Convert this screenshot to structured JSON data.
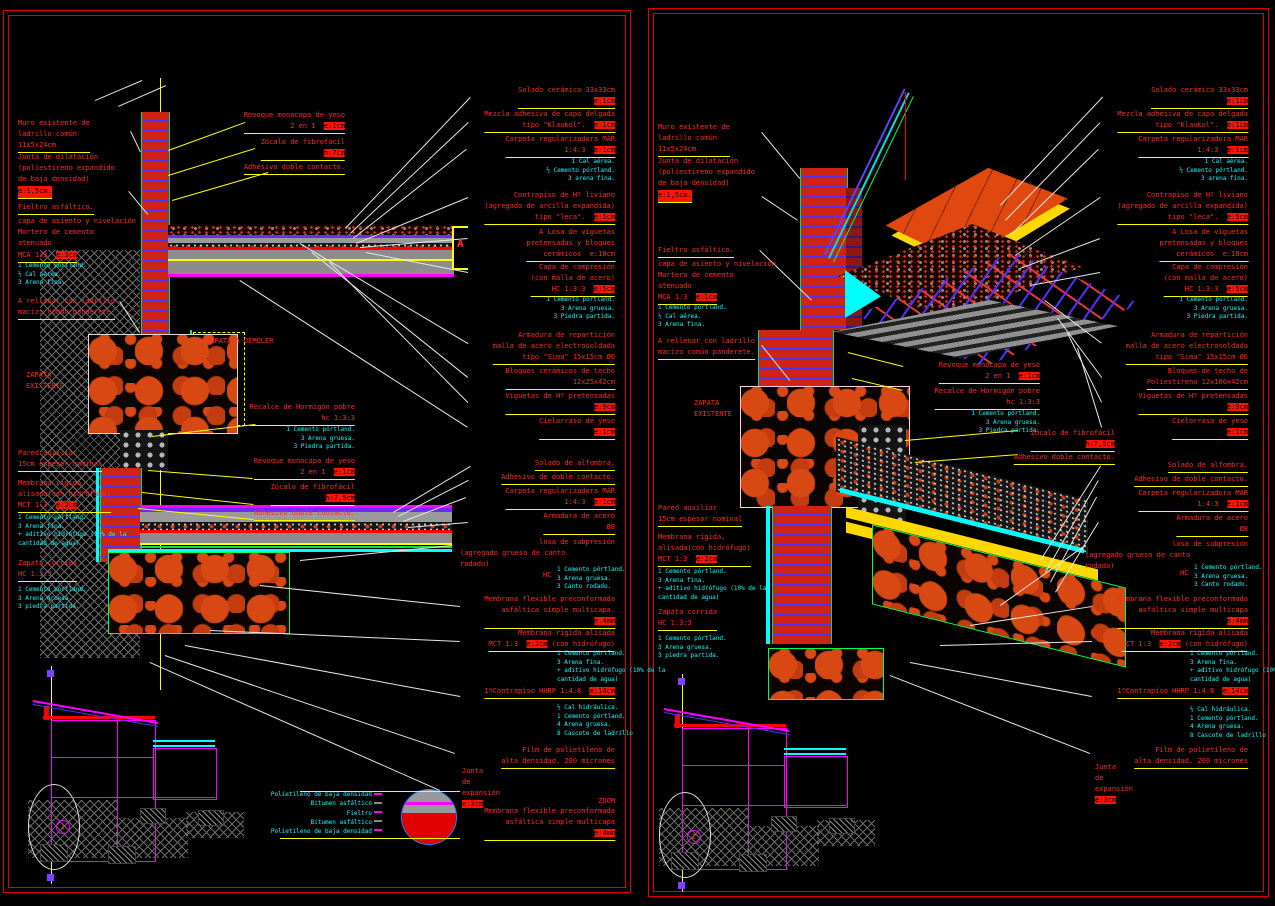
{
  "sheet": {
    "type": "CAD construction detail drawing",
    "background": "#000000",
    "colors": {
      "annotation_red": "#ff2a1e",
      "highlight_value": "#ff1400",
      "mix_notes_cyan": "#00ffff",
      "leader_yellow": "#ffff00",
      "leader_white": "#e8e8e8",
      "sketch_magenta": "#ff00ff",
      "brick_red": "#cf2414",
      "outline_green": "#00ff50",
      "panel_border_red": "#e00000"
    }
  },
  "panels": [
    {
      "name": "detalle-seccion-1",
      "marker": {
        "label": "1",
        "x": 56,
        "y": 820
      },
      "labels": [
        {
          "t": "Muro existente de\nladrillo común\n11x5x24cm",
          "x": 18,
          "y": 118,
          "ul": 1
        },
        {
          "t": "Junta de dilatación\n(poliestireno expandido\nde baja densidad)",
          "x": 18,
          "y": 152
        },
        {
          "t": "e:1,5cm.",
          "x": 18,
          "y": 186,
          "bg": 1,
          "ul": 1
        },
        {
          "t": "Fieltro asfáltico.",
          "x": 18,
          "y": 202,
          "ul": 1
        },
        {
          "t": "capa de asiento y nivelación\nMortero de cemento\natenuado",
          "x": 18,
          "y": 216
        },
        {
          "t": "MCA 1:3  ",
          "hl": "e:3cm",
          "x": 18,
          "y": 250,
          "ul": 1
        },
        {
          "t": "1 Cemento pórtland.\n½ Cal aérea.\n3 Arena fina.",
          "x": 18,
          "y": 262,
          "c": 1
        },
        {
          "t": "A rellenar con ladrillo\nmacizo común panderete",
          "x": 18,
          "y": 296,
          "ul": 1
        },
        {
          "t": "ZAPATA\nEXISTENTE",
          "x": 26,
          "y": 370
        },
        {
          "t": "ZAPATA A DEMOLER",
          "x": 206,
          "y": 336
        },
        {
          "t": "Pared auxiliar\n15cm espesor nominal",
          "x": 18,
          "y": 448,
          "ul": 1
        },
        {
          "t": "Membrana rígida,\nalisada(con hidrófugo)\nMCT 1:3  ",
          "hl": "e:2cm",
          "x": 18,
          "y": 478,
          "ul": 1
        },
        {
          "t": "1 Cemento pórtland.\n3 Arena fina.\n+ aditivo hidrófugo (10% de la\ncantidad de agua)",
          "x": 18,
          "y": 514,
          "c": 1
        },
        {
          "t": "Zapata corrida\nHC 1:3:3",
          "x": 18,
          "y": 558,
          "ul": 1
        },
        {
          "t": "1 Cemento pórtland.\n3 Arena gruesa.\n3 piedra partida.",
          "x": 18,
          "y": 586,
          "c": 1
        },
        {
          "t": "Revoque monocapa de yeso\n2 en 1  ",
          "hl": "e:1cm",
          "x": 345,
          "y": 110,
          "r": 1,
          "ul": 1
        },
        {
          "t": "Zócalo de fibrofácil\n",
          "hl": "h:7cm",
          "x": 345,
          "y": 137,
          "r": 1,
          "ul": 1
        },
        {
          "t": "Adhesivo doble contacto.",
          "x": 345,
          "y": 162,
          "r": 1,
          "ul": 1
        },
        {
          "t": "Recalce de Hormigón pobre\nhc 1:3:3",
          "x": 355,
          "y": 402,
          "r": 1,
          "ul": 1
        },
        {
          "t": "1 Cemento pórtland.\n3 Arena gruesa.\n3 Piedra partida.",
          "x": 355,
          "y": 426,
          "r": 1,
          "c": 1
        },
        {
          "t": "Revoque monocapa de yeso\n2 en 1  ",
          "hl": "e:1cm",
          "x": 355,
          "y": 456,
          "r": 1,
          "ul": 1
        },
        {
          "t": "Zócalo de fibrofácil\n",
          "hl": "h:7,5cm",
          "x": 355,
          "y": 482,
          "r": 1,
          "ul": 1
        },
        {
          "t": "Adhesivo doble contacto.",
          "x": 355,
          "y": 508,
          "r": 1,
          "ul": 1
        },
        {
          "t": "Solado cerámico 33x33cm\n",
          "hl": "e:1cm",
          "x": 615,
          "y": 85,
          "r": 1,
          "ul": 1
        },
        {
          "t": "Mezcla adhesiva de capa delgada\ntipo \"Klaukol\".  ",
          "hl": "e:1cm",
          "x": 615,
          "y": 109,
          "r": 1,
          "ul": 1
        },
        {
          "t": "Carpeta regularizadora MAR\n1:4:3  ",
          "hl": "e:1cm",
          "x": 615,
          "y": 134,
          "r": 1,
          "ul": 1
        },
        {
          "t": "1 Cal aérea.\n½ Cemento pórtland.\n3 arena fina.",
          "x": 615,
          "y": 158,
          "r": 1,
          "c": 1
        },
        {
          "t": "Contrapiso de Hº liviano\n(agregado de arcilla expandida)\ntipo \"leca\".  ",
          "hl": "e:5cm",
          "x": 615,
          "y": 190,
          "r": 1,
          "ul": 1
        },
        {
          "t": "A Losa de viguetas\npretensadas y bloques\ncerámicos  e:18cm",
          "x": 615,
          "y": 227,
          "r": 1,
          "ul": 1
        },
        {
          "t": "Capa de compresión\n(con malla de acero)\nHC 1:3:3  ",
          "hl": "e:5cm",
          "x": 615,
          "y": 262,
          "r": 1,
          "ul": 1
        },
        {
          "t": "1 Cemento pórtland.\n3 Arena gruesa.\n3 Piedra partida.",
          "x": 615,
          "y": 296,
          "r": 1,
          "c": 1
        },
        {
          "t": "Armadura de repartición\nmalla de acero electrosoldada\ntipo \"Sima\" 15x15cm Ø6",
          "x": 615,
          "y": 330,
          "r": 1,
          "ul": 1
        },
        {
          "t": "Bloques cerámicos de techo\n12x25x42cm",
          "x": 615,
          "y": 366,
          "r": 1,
          "ul": 1
        },
        {
          "t": "Viguetas de Hº pretensadas\n",
          "hl": "e:9cm",
          "x": 615,
          "y": 391,
          "r": 1,
          "ul": 1
        },
        {
          "t": "Cielorraso de yeso\n",
          "hl": "e:1cm",
          "x": 615,
          "y": 416,
          "r": 1,
          "ul": 1
        },
        {
          "t": "Solado de alfombra.",
          "x": 615,
          "y": 458,
          "r": 1,
          "ul": 1
        },
        {
          "t": "Adhesivo de doble contacto.",
          "x": 615,
          "y": 472,
          "r": 1,
          "ul": 1
        },
        {
          "t": "Carpeta regularizadora MAR\n1:4:3  ",
          "hl": "e:1cm",
          "x": 615,
          "y": 486,
          "r": 1,
          "ul": 1
        },
        {
          "t": "Armadura de acero\nØ8",
          "x": 615,
          "y": 511,
          "r": 1,
          "ul": 1
        },
        {
          "t": "losa de subpresión",
          "x": 615,
          "y": 537,
          "r": 1
        },
        {
          "t": "(agregado grueso de canto\nrodado)",
          "x": 460,
          "y": 548
        },
        {
          "t": "HC",
          "x": 543,
          "y": 570
        },
        {
          "t": "1 Cemento pórtland.\n3 Arena gruesa.\n3 Canto rodado.",
          "x": 557,
          "y": 566,
          "c": 1
        },
        {
          "t": "Membrana flexible preconformada\nasfáltica simple multicapa.\n",
          "hl": "e:4mm",
          "x": 615,
          "y": 594,
          "r": 1,
          "ul": 1
        },
        {
          "t": "Membrana rígida alisada\nMCT 1:3  ",
          "hl": "e:2cm",
          "tail": " (con hidrófugo)",
          "x": 615,
          "y": 628,
          "r": 1,
          "ul": 1
        },
        {
          "t": "1 Cemento pórtland.\n3 Arena fina.\n+ aditivo hidrófugo (10% de la\ncantidad de agua)",
          "x": 557,
          "y": 650,
          "c": 1
        },
        {
          "t": "1ºContrapiso HHRP 1:4:8  ",
          "hl": "e:14cm",
          "x": 615,
          "y": 686,
          "r": 1,
          "ul": 1
        },
        {
          "t": "½ Cal hidráulica.\n1 Cemento pórtland.\n4 Arena gruesa.\n8 Cascote de ladrillo",
          "x": 557,
          "y": 704,
          "c": 1
        },
        {
          "t": "Film de polietileno de\nalta densidad. 200 micrones",
          "x": 615,
          "y": 745,
          "r": 1,
          "ul": 1
        },
        {
          "t": "Junta\nde\nexpansión\n",
          "hl": "e:3cm",
          "x": 462,
          "y": 766
        },
        {
          "t": "ZOOM",
          "x": 615,
          "y": 796,
          "r": 1
        },
        {
          "t": "Membrana flexible preconformada\nasfáltica simple multicapa\n",
          "hl": "e:4mm",
          "x": 615,
          "y": 806,
          "r": 1,
          "ul": 1
        },
        {
          "t": "Polietileno de baja densidad\nBitumen asfáltico\nFieltro\nBitumen asfáltico\nPolietileno de baja densidad",
          "x": 372,
          "y": 790,
          "r": 1,
          "c": 1,
          "z": 1
        },
        {
          "t": "A",
          "x": 457,
          "y": 238,
          "big": 1
        }
      ]
    },
    {
      "name": "detalle-axonometrico-2",
      "marker": {
        "label": "2",
        "x": 687,
        "y": 830
      },
      "labels": [
        {
          "t": "Muro existente de\nladrillo común\n11x5x24cm",
          "x": 658,
          "y": 122,
          "ul": 1
        },
        {
          "t": "Junta de dilatación\n(poliestireno expandido\nde baja densidad)",
          "x": 658,
          "y": 156
        },
        {
          "t": "e:1,5cm.",
          "x": 658,
          "y": 190,
          "bg": 1,
          "ul": 1
        },
        {
          "t": "Fieltro asfáltico.",
          "x": 658,
          "y": 245,
          "ul": 1
        },
        {
          "t": "capa de asiento y nivelación\nMortero de cemento\natenuado",
          "x": 658,
          "y": 259
        },
        {
          "t": "MCA 1:3  ",
          "hl": "e:1cm",
          "x": 658,
          "y": 292,
          "ul": 1
        },
        {
          "t": "1 Cemento pórtland.\n½ Cal aérea.\n3 Arena fina.",
          "x": 658,
          "y": 304,
          "c": 1
        },
        {
          "t": "A rellenar con ladrillo\nmacizo común panderete.",
          "x": 658,
          "y": 336,
          "ul": 1
        },
        {
          "t": "ZAPATA\nEXISTENTE",
          "x": 694,
          "y": 398
        },
        {
          "t": "Pared auxiliar\n15cm espesor nominal",
          "x": 658,
          "y": 503,
          "ul": 1
        },
        {
          "t": "Membrana rígida,\nalisada(con hidrófugo)\nMCT 1:3  ",
          "hl": "e:2cm",
          "x": 658,
          "y": 532,
          "ul": 1
        },
        {
          "t": "1 Cemento pórtland.\n3 Arena fina.\n+ aditivo hidrófugo (10% de la\ncantidad de agua)",
          "x": 658,
          "y": 568,
          "c": 1
        },
        {
          "t": "Zapata corrida\nHC 1:3:3",
          "x": 658,
          "y": 607,
          "ul": 1
        },
        {
          "t": "1 Cemento pórtland.\n3 Arena gruesa.\n3 piedra partida.",
          "x": 658,
          "y": 635,
          "c": 1
        },
        {
          "t": "Revoque monocapa de yeso\n2 en 1  ",
          "hl": "e:1cm",
          "x": 1040,
          "y": 360,
          "r": 1,
          "ul": 1
        },
        {
          "t": "Recalce de Hormigón pobre\nhc 1:3:3",
          "x": 1040,
          "y": 386,
          "r": 1,
          "ul": 1
        },
        {
          "t": "1 Cemento pórtland.\n3 Arena gruesa.\n3 Piedra partida.",
          "x": 1040,
          "y": 410,
          "r": 1,
          "c": 1
        },
        {
          "t": "Zócalo de fibrofácil\n",
          "hl": "h:7,5cm",
          "x": 1115,
          "y": 428,
          "r": 1,
          "ul": 1
        },
        {
          "t": "Adhesivo doble contacto.",
          "x": 1115,
          "y": 452,
          "r": 1,
          "ul": 1
        },
        {
          "t": "Solado cerámico 33x33cm\n",
          "hl": "e:1cm",
          "x": 1248,
          "y": 85,
          "r": 1,
          "ul": 1
        },
        {
          "t": "Mezcla adhesiva de capa delgada\ntipo \"Klaukol\".  ",
          "hl": "e:1cm",
          "x": 1248,
          "y": 109,
          "r": 1,
          "ul": 1
        },
        {
          "t": "Carpeta regularizadora MAR\n1:4:3  ",
          "hl": "e:1cm",
          "x": 1248,
          "y": 134,
          "r": 1,
          "ul": 1
        },
        {
          "t": "1 Cal aérea.\n½ Cemento pórtland.\n3 arena fina.",
          "x": 1248,
          "y": 158,
          "r": 1,
          "c": 1
        },
        {
          "t": "Contrapiso de Hº liviano\n(agregado de arcilla expandida)\ntipo \"leca\".  ",
          "hl": "e:5cm",
          "x": 1248,
          "y": 190,
          "r": 1,
          "ul": 1
        },
        {
          "t": "A Losa de viguetas\npretensadas y bloques\ncerámicos  e:18cm",
          "x": 1248,
          "y": 227,
          "r": 1,
          "ul": 1
        },
        {
          "t": "Capa de compresión\n(con malla de acero)\nHC 1:3:3  ",
          "hl": "e:5cm",
          "x": 1248,
          "y": 262,
          "r": 1,
          "ul": 1
        },
        {
          "t": "1 Cemento pórtland.\n3 Arena gruesa.\n3 Piedra partida.",
          "x": 1248,
          "y": 296,
          "r": 1,
          "c": 1
        },
        {
          "t": "Armadura de repartición\nmalla de acero electrosoldada\ntipo \"Sima\" 15x15cm Ø6",
          "x": 1248,
          "y": 330,
          "r": 1,
          "ul": 1
        },
        {
          "t": "Bloques de techo de\nPoliestireno 12x100x42cm",
          "x": 1248,
          "y": 366,
          "r": 1,
          "ul": 1
        },
        {
          "t": "Viguetas de Hº pretensadas\n",
          "hl": "e:9cm",
          "x": 1248,
          "y": 391,
          "r": 1,
          "ul": 1
        },
        {
          "t": "Cielorraso de yeso\n",
          "hl": "e:1cm",
          "x": 1248,
          "y": 416,
          "r": 1,
          "ul": 1
        },
        {
          "t": "Solado de alfombra.",
          "x": 1248,
          "y": 460,
          "r": 1,
          "ul": 1
        },
        {
          "t": "Adhesivo de doble contacto.",
          "x": 1248,
          "y": 474,
          "r": 1,
          "ul": 1
        },
        {
          "t": "Carpeta regularizadora MAR\n1:4:3  ",
          "hl": "e:1cm",
          "x": 1248,
          "y": 488,
          "r": 1,
          "ul": 1
        },
        {
          "t": "Armadura de acero\nØ8",
          "x": 1248,
          "y": 513,
          "r": 1,
          "ul": 1
        },
        {
          "t": "losa de subpresión",
          "x": 1248,
          "y": 539,
          "r": 1
        },
        {
          "t": "(agregado grueso de canto\nrodado)",
          "x": 1085,
          "y": 550
        },
        {
          "t": "HC",
          "x": 1180,
          "y": 568
        },
        {
          "t": "1 Cemento pórtland.\n3 Arena gruesa.\n3 Canto rodado.",
          "x": 1194,
          "y": 564,
          "c": 1
        },
        {
          "t": "Membrana flexible preconformada\nasfáltica simple multicapa\n",
          "hl": "e:4mm",
          "x": 1248,
          "y": 594,
          "r": 1,
          "ul": 1
        },
        {
          "t": "Membrana rígida alisada\nMCT 1:3  ",
          "hl": "e:2cm",
          "tail": " (con hidrófugo)",
          "x": 1248,
          "y": 628,
          "r": 1,
          "ul": 1
        },
        {
          "t": "1 Cemento pórtland.\n3 Arena fina.\n+ aditivo hidrófugo (10% de la\ncantidad de agua)",
          "x": 1190,
          "y": 650,
          "c": 1
        },
        {
          "t": "1ºContrapiso HHRP 1:4:8  ",
          "hl": "e:14cm",
          "x": 1248,
          "y": 686,
          "r": 1,
          "ul": 1
        },
        {
          "t": "½ Cal hidráulica.\n1 Cemento pórtland.\n4 Arena gruesa.\n8 Cascote de ladrillo",
          "x": 1190,
          "y": 706,
          "c": 1
        },
        {
          "t": "Film de polietileno de\nalta densidad. 200 micrones",
          "x": 1248,
          "y": 745,
          "r": 1,
          "ul": 1
        },
        {
          "t": "Junta\nde\nexpansión\n",
          "hl": "e:3cm",
          "x": 1095,
          "y": 762
        }
      ]
    }
  ]
}
